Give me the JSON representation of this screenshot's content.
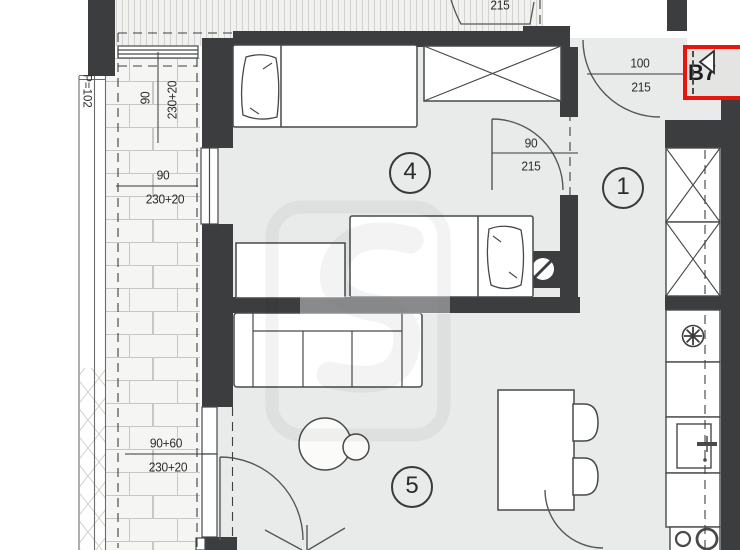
{
  "plan": {
    "unit_badge": {
      "label": "B7",
      "pointer_icon": "left-triangle",
      "highlight_color": "#e8150d"
    },
    "balcony_area_label": "P=102",
    "rooms": [
      {
        "key": "hallway",
        "number": "1"
      },
      {
        "key": "bedroom",
        "number": "4"
      },
      {
        "key": "living_room",
        "number": "5"
      }
    ],
    "dimensions": {
      "entrance_door": {
        "width": "100",
        "height": "215"
      },
      "bedroom_door": {
        "width": "90",
        "height": "215"
      },
      "balcony_window": {
        "width": "90",
        "height": "230+20"
      },
      "balcony_door_upper": {
        "width": "90",
        "height": "230+20"
      },
      "balcony_door_lower": {
        "width": "90+60",
        "height": "230+20"
      },
      "neighbor_unit_partial": "215"
    },
    "colors": {
      "wall": "#3b3d3f",
      "floor": "#e9eaea",
      "balcony_floor": "#f5f5f3",
      "highlight": "#e8150d"
    }
  }
}
